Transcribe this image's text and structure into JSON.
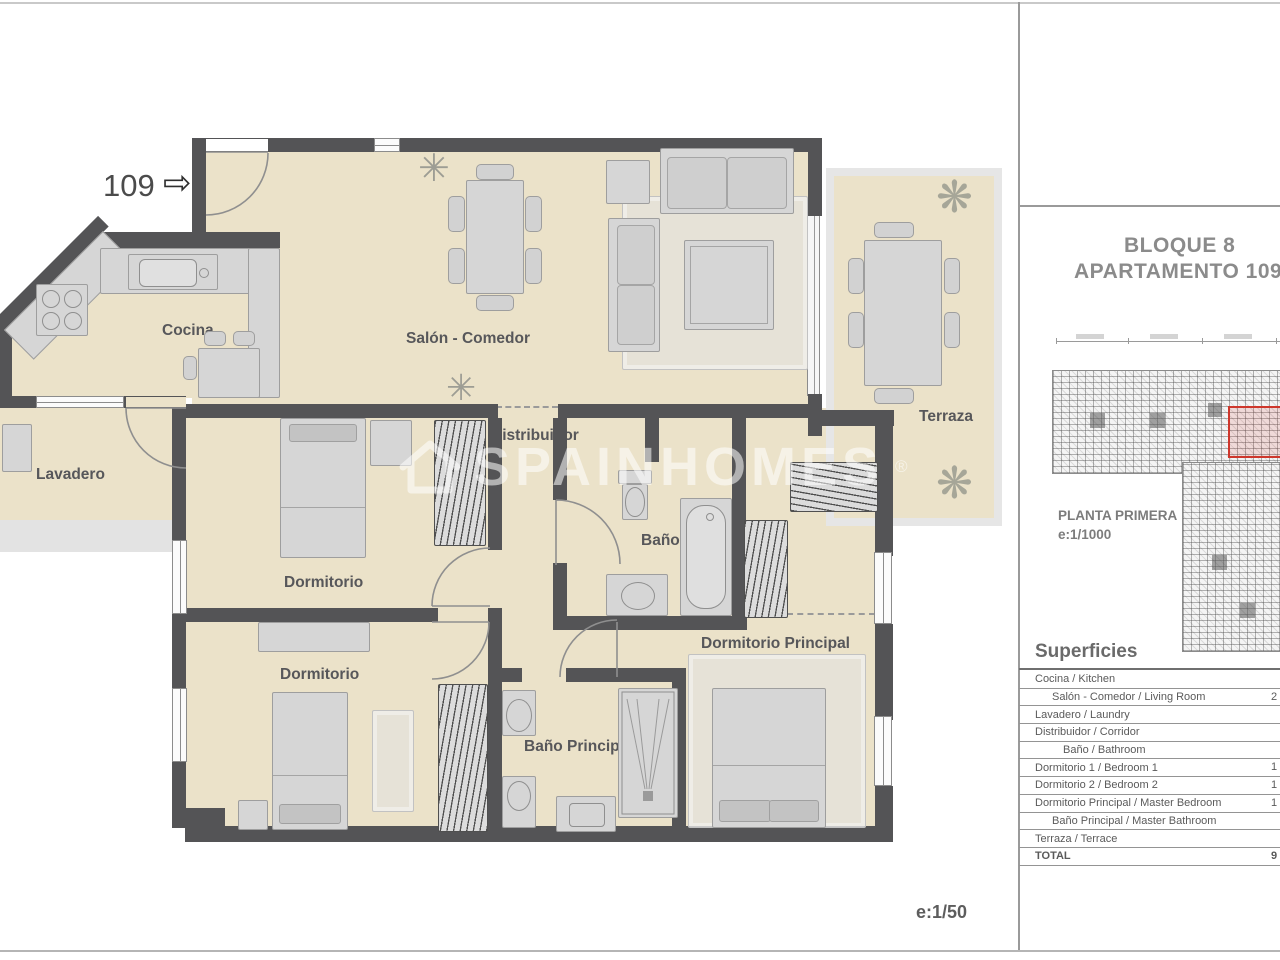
{
  "page": {
    "scale_label": "e:1/50"
  },
  "icons": {
    "fan": "✳",
    "plant": "❋",
    "entry_arrow": "⇨"
  },
  "plan": {
    "unit_number": "109",
    "watermark": {
      "text": "SPAINHOMES",
      "reg": "®"
    },
    "rooms": {
      "cocina": "Cocina",
      "salon": "Salón - Comedor",
      "terraza": "Terraza",
      "lavadero": "Lavadero",
      "distribuidor": "Distribuidor",
      "bano": "Baño",
      "dormitorio_1": "Dormitorio",
      "dormitorio_2": "Dormitorio",
      "dormitorio_principal": "Dormitorio Principal",
      "bano_principal": "Baño Principal"
    }
  },
  "sidebar": {
    "title_line1": "BLOQUE 8",
    "title_line2": "APARTAMENTO 109",
    "key_plan_caption": {
      "line1": "PLANTA PRIMERA",
      "line2": "e:1/1000"
    },
    "superficies": {
      "heading": "Superficies",
      "rows": [
        {
          "label": "Cocina / Kitchen",
          "value": "",
          "indent": 0,
          "bold": false
        },
        {
          "label": "Salón - Comedor / Living Room",
          "value": "2",
          "indent": 1,
          "bold": false
        },
        {
          "label": "Lavadero / Laundry",
          "value": "",
          "indent": 0,
          "bold": false
        },
        {
          "label": "Distribuidor / Corridor",
          "value": "",
          "indent": 0,
          "bold": false
        },
        {
          "label": "Baño / Bathroom",
          "value": "",
          "indent": 2,
          "bold": false
        },
        {
          "label": "Dormitorio 1 / Bedroom 1",
          "value": "1",
          "indent": 0,
          "bold": false
        },
        {
          "label": "Dormitorio 2 / Bedroom 2",
          "value": "1",
          "indent": 0,
          "bold": false
        },
        {
          "label": "Dormitorio Principal / Master Bedroom",
          "value": "1",
          "indent": 0,
          "bold": false
        },
        {
          "label": "Baño Principal / Master Bathroom",
          "value": "",
          "indent": 1,
          "bold": false
        },
        {
          "label": "Terraza / Terrace",
          "value": "",
          "indent": 0,
          "bold": false
        },
        {
          "label": "TOTAL",
          "value": "9",
          "indent": 0,
          "bold": true
        }
      ]
    }
  }
}
